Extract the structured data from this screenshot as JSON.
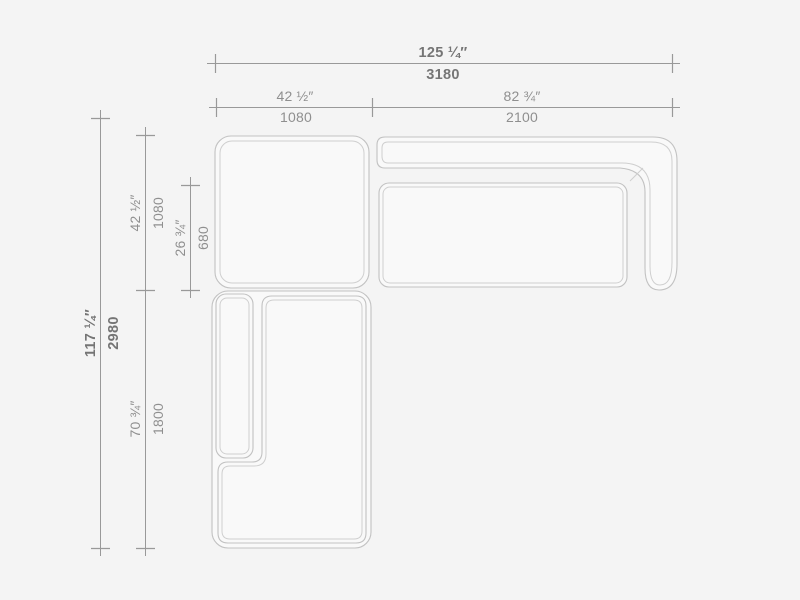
{
  "drawing": {
    "type": "sofa-plan-top-view",
    "colors": {
      "background": "#f4f4f4",
      "module_fill": "#f9f9f9",
      "module_stroke": "#c2c2c2",
      "module_stroke_inner": "#cfcfcf",
      "dim_line": "#999999",
      "dim_text": "#8f8f8f",
      "dim_text_strong": "#757575"
    },
    "dimensions": {
      "overall_width": {
        "inches": "125 ¼″",
        "mm": "3180"
      },
      "left_section_width": {
        "inches": "42 ½″",
        "mm": "1080"
      },
      "right_section_width": {
        "inches": "82 ¾″",
        "mm": "2100"
      },
      "overall_depth": {
        "inches": "117 ¼″",
        "mm": "2980"
      },
      "upper_section_depth": {
        "inches": "42 ½″",
        "mm": "1080"
      },
      "seat_depth": {
        "inches": "26 ¾″",
        "mm": "680"
      },
      "lower_section_depth": {
        "inches": "70 ¾″",
        "mm": "1800"
      }
    }
  }
}
